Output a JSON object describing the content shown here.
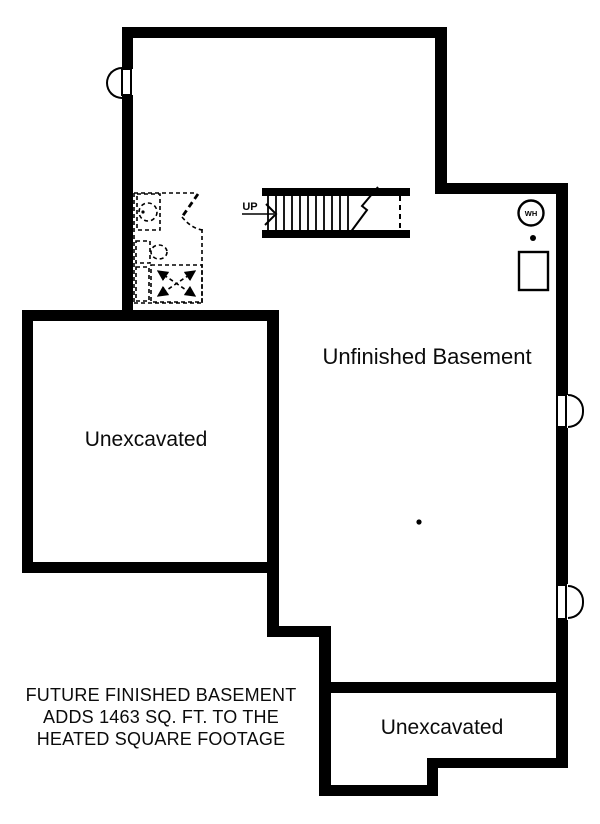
{
  "colors": {
    "wall": "#000000",
    "background": "#ffffff"
  },
  "rooms": {
    "unfinished_basement": {
      "label": "Unfinished Basement"
    },
    "unexcavated_left": {
      "label": "Unexcavated"
    },
    "unexcavated_bottom": {
      "label": "Unexcavated"
    }
  },
  "stairs": {
    "up_label": "UP"
  },
  "equipment": {
    "water_heater_label": "WH"
  },
  "note": {
    "line1": "FUTURE FINISHED BASEMENT",
    "line2": "ADDS 1463 SQ. FT. TO THE",
    "line3": "HEATED SQUARE FOOTAGE"
  }
}
